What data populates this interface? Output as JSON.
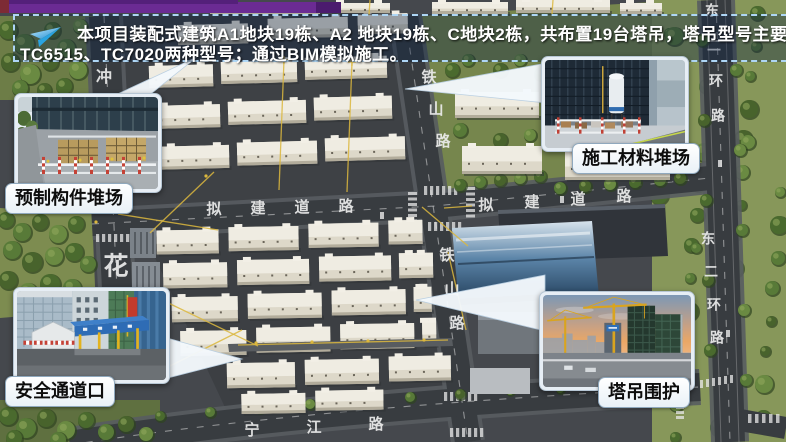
{
  "slide": {
    "banner": {
      "icon": "paper-plane-icon",
      "line1": "本项目装配式建筑A1地块19栋、A2 地块19栋、C地块2栋，共布置19台塔吊，塔吊型号主要使用",
      "line2": "TC6515、TC7020两种型号；通过BIM模拟施工。"
    },
    "callouts": [
      {
        "key": "prefab_yard",
        "label": "预制构件堆场"
      },
      {
        "key": "material_yard",
        "label": "施工材料堆场"
      },
      {
        "key": "safety_entrance",
        "label": "安全通道口"
      },
      {
        "key": "crane_enclosure",
        "label": "塔吊围护"
      }
    ],
    "map_labels": [
      {
        "text": "铁山路",
        "x": 429,
        "y": 78,
        "dx": 7,
        "dy": 32,
        "size": 15
      },
      {
        "text": "铁山路",
        "x": 447,
        "y": 256,
        "dx": 5,
        "dy": 34,
        "size": 15
      },
      {
        "text": "拟建道路",
        "x": 214,
        "y": 210,
        "dx": 44,
        "dy": -1,
        "size": 15
      },
      {
        "text": "拟建道路",
        "x": 486,
        "y": 206,
        "dx": 46,
        "dy": -3,
        "size": 15
      },
      {
        "text": "东二环路",
        "x": 712,
        "y": 12,
        "dx": 2,
        "dy": 35,
        "size": 14
      },
      {
        "text": "东二环路",
        "x": 708,
        "y": 240,
        "dx": 3,
        "dy": 33,
        "size": 14
      },
      {
        "text": "宁江路",
        "x": 252,
        "y": 431,
        "dx": 62,
        "dy": -3,
        "size": 15
      },
      {
        "text": "花",
        "x": 116,
        "y": 268,
        "dx": 0,
        "dy": 0,
        "size": 25
      },
      {
        "text": "冲",
        "x": 104,
        "y": 78,
        "dx": 0,
        "dy": 0,
        "size": 16
      }
    ],
    "colors": {
      "accent_purple": "#6b2b93",
      "banner_border": "#aed6f5",
      "arrow_fill": "#f4f9fd",
      "label_bg": "#f7fafc",
      "crane_yellow": "#d9b53c"
    }
  }
}
